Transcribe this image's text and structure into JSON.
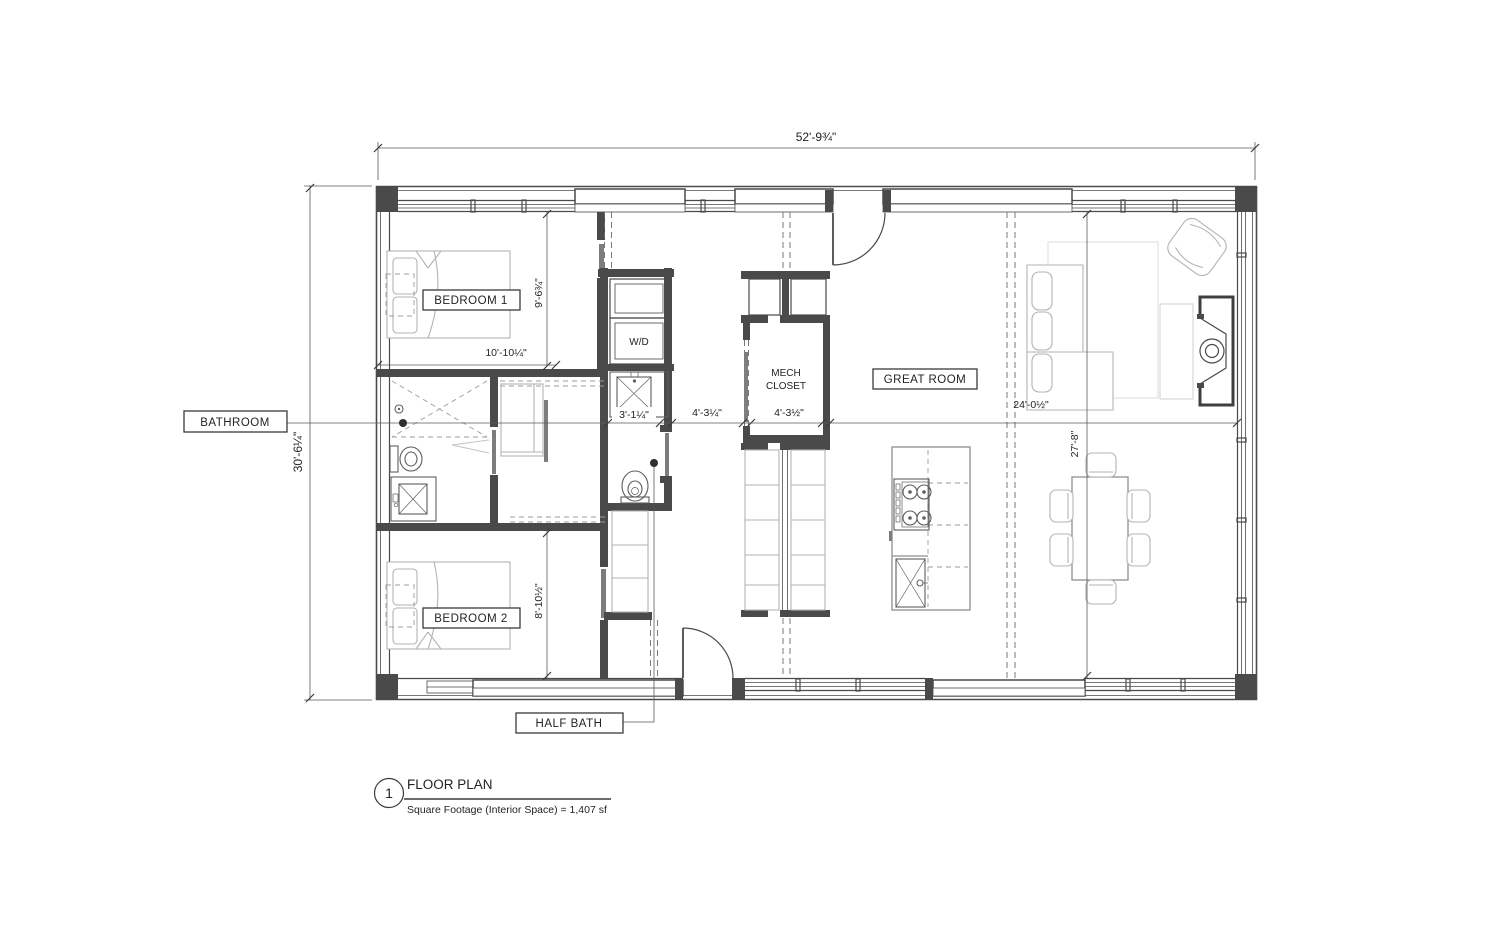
{
  "style": {
    "background": "#ffffff",
    "line_color": "#4a4a4a",
    "furniture_line_color": "#b3b3b3"
  },
  "title_block": {
    "detail_number": "1",
    "title": "FLOOR PLAN",
    "note": "Square Footage (Interior Space) = 1,407 sf"
  },
  "rooms": {
    "bedroom_1": "BEDROOM 1",
    "bedroom_2": "BEDROOM 2",
    "bathroom": "BATHROOM",
    "half_bath": "HALF BATH",
    "great_room": "GREAT ROOM",
    "mech_closet_line1": "MECH",
    "mech_closet_line2": "CLOSET",
    "washer_dryer": "W/D"
  },
  "dimensions": {
    "overall_width": "52'-9¾\"",
    "overall_depth": "30'-6¼\"",
    "bedroom_1_depth": "9'-6¾\"",
    "bedroom_1_width": "10'-10¼\"",
    "bedroom_2_depth": "8'-10½\"",
    "half_bath_width": "3'-1¼\"",
    "hall_width": "4'-3¼\"",
    "mech_closet_width": "4'-3½\"",
    "great_room_width": "24'-0½\"",
    "great_room_depth": "27'-8\""
  }
}
